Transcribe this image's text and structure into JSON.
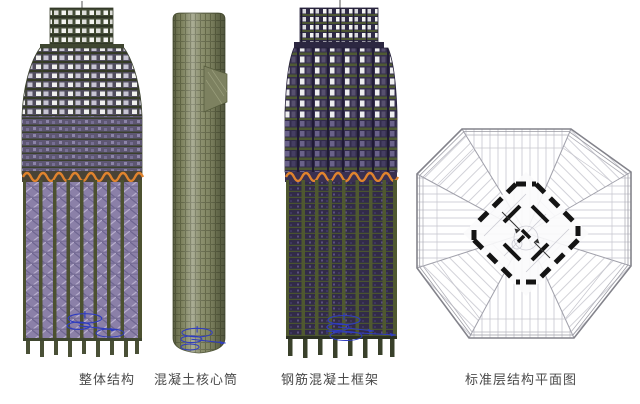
{
  "panels": [
    {
      "id": "overall-structure",
      "label": "整体结构"
    },
    {
      "id": "concrete-core-tube",
      "label": "混凝土核心筒"
    },
    {
      "id": "rc-frame",
      "label": "钢筋混凝土框架"
    },
    {
      "id": "typical-floor-plan",
      "label": "标准层结构平面图"
    }
  ],
  "colors": {
    "background": "#ffffff",
    "caption_text": "#4a4a4a",
    "belt_truss_orange": "#e0832e",
    "axis_annotation_blue": "#2f3cc0",
    "core_wall_black": "#141414",
    "column_green": "#4c5130",
    "lattice_purple": "#8a7fa6",
    "floor_olive": "#47503a",
    "frame_purple": "#342d4c",
    "plan_line_gray": "#9a9aa2",
    "window_white": "#ffffff"
  }
}
